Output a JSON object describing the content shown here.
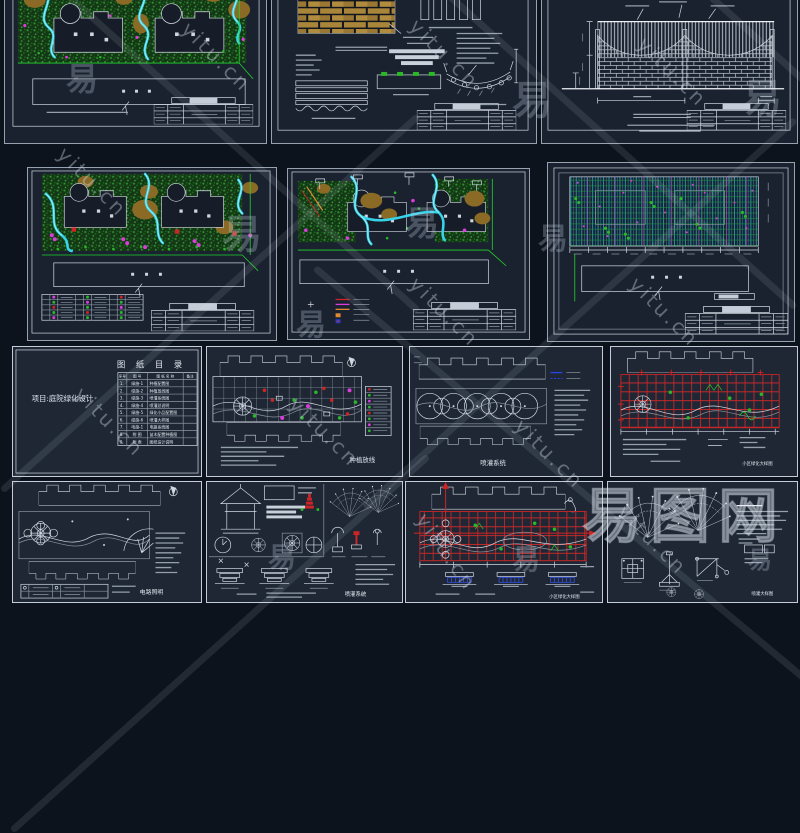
{
  "page": {
    "background": "#0d131c",
    "sheet_background": "#1a2230",
    "border_color": "#97a2b0"
  },
  "palette": {
    "water_cyan": "#36d3ea",
    "vegetation_green": "#2a8f2a",
    "line_green": "#22d42a",
    "magenta": "#dd3cdd",
    "red": "#cc2525",
    "tan_brick": "#a9853a",
    "blue": "#3050e0",
    "white_line": "#d3dae3"
  },
  "watermark": {
    "url_text": "yitu.cn",
    "char": "易",
    "logo_text": "易图网"
  },
  "catalog": {
    "title": "图 纸 目 录",
    "project": "项目:庭院绿化设计",
    "headers": {
      "no": "序号",
      "code": "图 号",
      "name": "图 纸 名 称",
      "note": "备注"
    },
    "rows": [
      {
        "no": "1.",
        "code": "绿施-1",
        "name": "种植配置图"
      },
      {
        "no": "2.",
        "code": "绿施-2",
        "name": "种植放线图"
      },
      {
        "no": "3.",
        "code": "绿施-3",
        "name": "喷灌系统图"
      },
      {
        "no": "4.",
        "code": "绿施-4",
        "name": "喷灌总说明"
      },
      {
        "no": "5.",
        "code": "绿施-5",
        "name": "绿化小品配置图"
      },
      {
        "no": "6.",
        "code": "绿施-6",
        "name": "喷灌大样图"
      },
      {
        "no": "7.",
        "code": "电施-1",
        "name": "电路系统图"
      },
      {
        "no": "8.",
        "code": "附 图",
        "name": "苗木配置种植图"
      },
      {
        "no": "9.",
        "code": "附 表",
        "name": "图纸设计说明"
      }
    ]
  },
  "sheet_labels": {
    "planting_setout": "种植放线",
    "irrigation_system": "喷灌系统",
    "district_green_detail": "小区绿化大样图",
    "electric_lighting": "电路照明",
    "irrigation_system_2": "喷灌系统",
    "district_green_detail_2": "小区绿化大样图",
    "irrigation_detail": "喷灌大样图"
  }
}
